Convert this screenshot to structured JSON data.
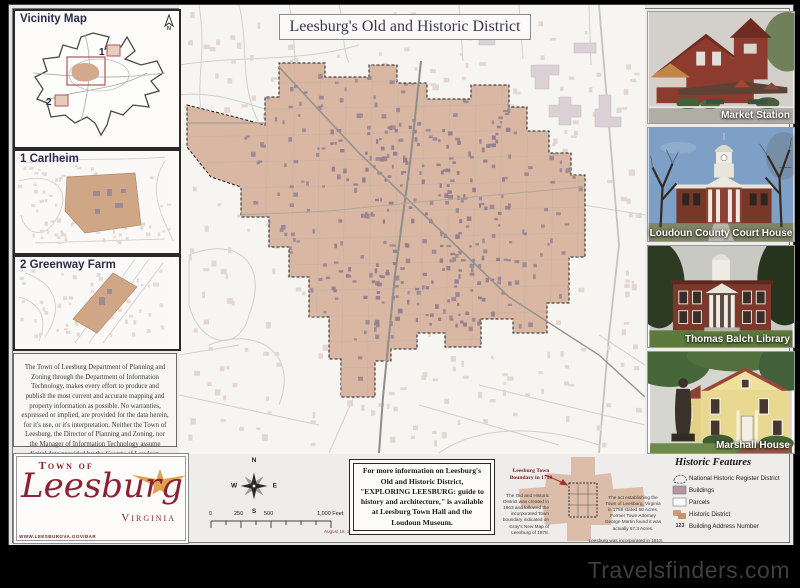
{
  "title": "Leesburg's Old and Historic District",
  "vicinity": {
    "title": "Vicinity Map",
    "north_label": "N",
    "marker_1": "1",
    "marker_2": "2"
  },
  "inset_carlheim": {
    "label": "1 Carlheim"
  },
  "inset_greenway": {
    "label": "2 Greenway Farm"
  },
  "disclaimer": "The Town of Leesburg Department of Planning and Zoning through the Department of Information Technology, makes every effort to produce and publish the most current and accurate mapping and property information as possible. No warranties, expressed or implied, are provided for the data herein, for it's use, or it's interpretation. Neither the Town of Leesburg, the Director of Planning and Zoning, nor the Manager of Information Technology assume digital data provided by the County of Loudoun, Office of Mapping and Geographic Information.",
  "photos": [
    {
      "label": "Market Station"
    },
    {
      "label": "Loudoun County Court House"
    },
    {
      "label": "Thomas Balch Library"
    },
    {
      "label": "Marshall House"
    }
  ],
  "logo": {
    "line1": "Town of",
    "name": "Leesburg",
    "state": "Virginia",
    "url": "WWW.LEESBURGVA.GOV/BAR"
  },
  "compass": {
    "n": "N",
    "e": "E",
    "s": "S",
    "w": "W"
  },
  "scalebar": {
    "t0": "0",
    "t250": "250",
    "t500": "500",
    "tend": "1,000 Feet",
    "date": "August 18, 2011"
  },
  "info_box": {
    "text": "For more information on Leesburg's Old and Historic District, \"EXPLORING LEESBURG: guide to history and architecture,\" is available at Leesburg Town Hall and the Loudoun Museum."
  },
  "boundary_1758": {
    "callout": "Leesburg Town Boundary in 1758",
    "left_note": "The Old and Historic District was created in 1963 and followed the incorporated Town boundary indicated on Gray's New Map of Leesburg of 1878.",
    "right_note": "The act establishing the Town of Leesburg, Virginia in 1758 stated 60 Acres. Former Town Attorney George Martin found it was actually 67.3 Acres.",
    "footnote": "Leesburg was incorporated in 1813."
  },
  "legend": {
    "title": "Historic Features",
    "address_sample": "123",
    "items": [
      "National Historic Register District",
      "Buildings",
      "Parcels",
      "Historic District",
      "Building Address Number"
    ]
  },
  "watermark": "Travelsfinders.com",
  "colors": {
    "historic_district_tan": "#d9b7a3",
    "building_mauve": "#9c8a97",
    "outside_building_pink": "#e4d7d0",
    "logo_maroon": "#8b2232",
    "star_gold": "#dfa14e",
    "vicinity_red": "#b05858"
  }
}
